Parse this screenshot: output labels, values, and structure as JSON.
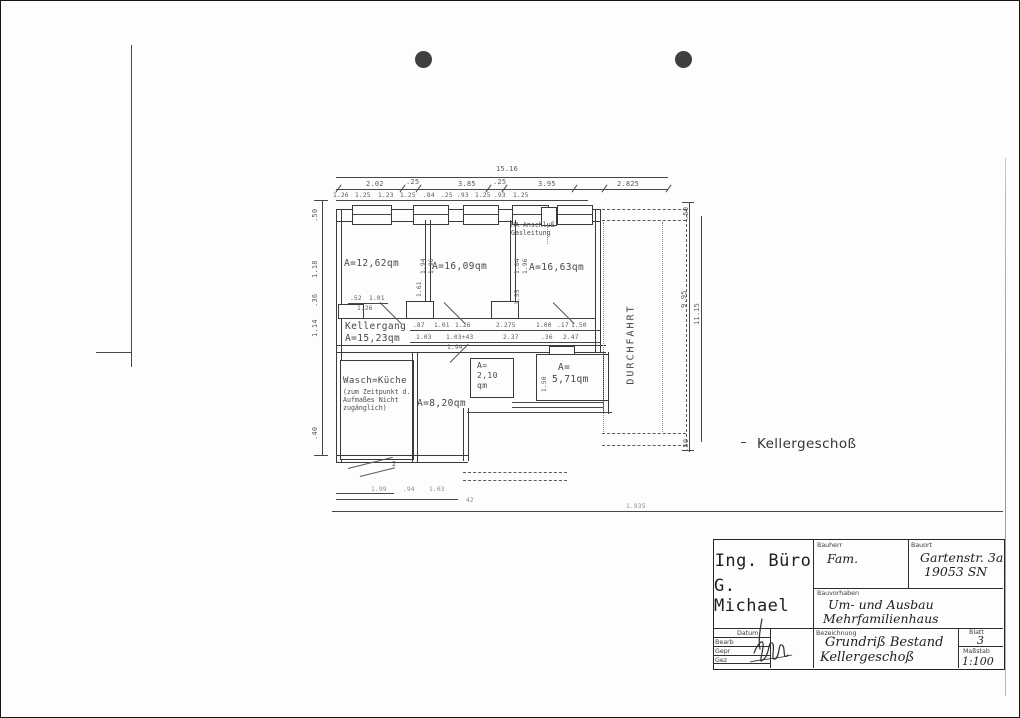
{
  "scan": {
    "punch_hole_color": "#3f3f41"
  },
  "plan": {
    "floor_label": "Kellergeschoß",
    "durchfahrt_label": "DURCHFAHRT",
    "overall_width": "15.16",
    "top_dims_row1": [
      "2.02",
      ".25",
      "3.85",
      ".25",
      "3.95",
      "2.825"
    ],
    "top_dims_row2": [
      "1.26",
      "1.25",
      "1.23",
      "1.25",
      ".84",
      ".25",
      ".93",
      "1.25",
      ".93",
      "1.25"
    ],
    "left_dims": [
      ".50",
      "1.18",
      ".36",
      "1.14",
      ".40"
    ],
    "right_dims": [
      ".50",
      "9.95",
      "11.15",
      ".50"
    ],
    "bottom_dims": [
      "1.99",
      ".94",
      "1.03",
      "42",
      "1.935"
    ],
    "corridor_dims_row1": [
      ".87",
      "1.01",
      "1.26",
      "2.275",
      "1.00",
      ".17",
      "1.50"
    ],
    "corridor_dims_row2": [
      "1.03",
      "1.03+43",
      "2.37",
      ".36",
      "2.47"
    ],
    "corridor_dim_below": "1.94",
    "inner_dims": {
      "d52": ".52",
      "d101": "1.01",
      "d126": "1.26",
      "p194": "1.94",
      "p196": "1.96",
      "p104": "1.04",
      "p196b": "1.96",
      "p155": "1.55",
      "p161": "1.61",
      "p150": "1.50",
      "ramp": "2"
    },
    "rooms": {
      "room1_area": "A=12,62qm",
      "room2_area": "A=16,09qm",
      "room3_area": "A=16,63qm",
      "kellergang_name": "Kellergang",
      "kellergang_area": "A=15,23qm",
      "wasch_name": "Wasch=Küche",
      "wasch_note1": "(zum Zeitpunkt d.",
      "wasch_note2": "Aufmaßes Nicht",
      "wasch_note3": "zugänglich)",
      "room4_area": "A=8,20qm",
      "room5_line1": "A=",
      "room5_line2": "2,10",
      "room5_line3": "qm",
      "room6_line1": "A=",
      "room6_line2": "5,71qm"
    },
    "ha_note_line1": "HA-Anschluß",
    "ha_note_line2": "Gasleitung"
  },
  "title_block": {
    "firm_line1": "Ing. Büro",
    "firm_line2": "G. Michael",
    "bauherr_label": "Bauherr",
    "bauherr_value": "Fam.",
    "bauort_label": "Bauort",
    "bauort_value1": "Gartenstr. 3a",
    "bauort_value2": "19053 SN",
    "bauvorhaben_label": "Bauvorhaben",
    "bauvorhaben_value1": "Um- und Ausbau",
    "bauvorhaben_value2": "Mehrfamilienhaus",
    "bezeichnung_label": "Bezeichnung",
    "bezeichnung_value1": "Grundriß Bestand",
    "bezeichnung_value2": "Kellergeschoß",
    "datum_label": "Datum",
    "row_labels": [
      "Bearb",
      "Gepr",
      "Gez"
    ],
    "blatt_label": "Blatt",
    "blatt_value": "3",
    "massstab_label": "Maßstab",
    "massstab_value": "1:100"
  }
}
